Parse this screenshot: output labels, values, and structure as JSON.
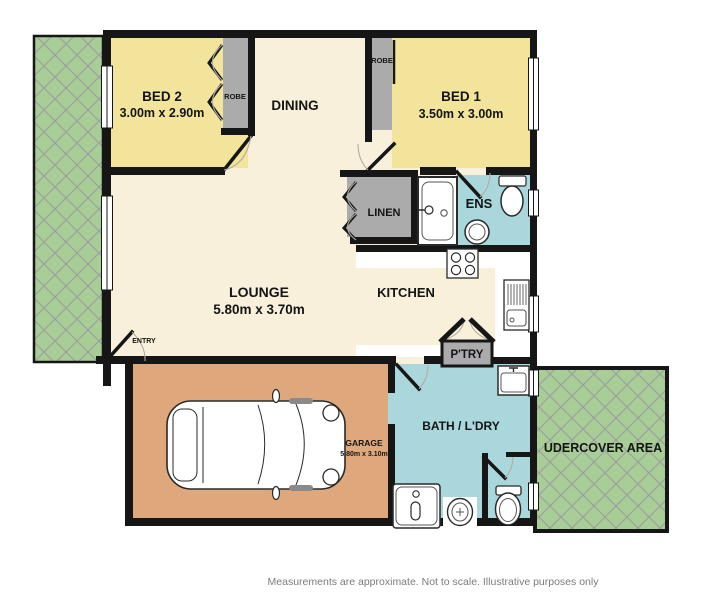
{
  "plan": {
    "rooms": {
      "bed2": {
        "name": "BED 2",
        "dims": "3.00m x 2.90m"
      },
      "bed1": {
        "name": "BED 1",
        "dims": "3.50m x 3.00m"
      },
      "dining": {
        "name": "DINING"
      },
      "lounge": {
        "name": "LOUNGE",
        "dims": "5.80m x 3.70m"
      },
      "kitchen": {
        "name": "KITCHEN"
      },
      "linen": {
        "name": "LINEN"
      },
      "ens": {
        "name": "ENS"
      },
      "pantry": {
        "name": "P'TRY"
      },
      "bath": {
        "name": "BATH / L'DRY"
      },
      "garage": {
        "name": "GARAGE",
        "dims": "5.80m x 3.10m"
      },
      "undercover": {
        "name": "UDERCOVER AREA"
      },
      "robe_bed2": {
        "name": "ROBE"
      },
      "robe_bed1": {
        "name": "ROBE"
      },
      "entry": {
        "name": "ENTRY"
      }
    },
    "colors": {
      "floor_cream": "#f9f0dc",
      "bedroom_yellow": "#f2e49b",
      "wet_area_blue": "#aad7dc",
      "garage_tan": "#dfa87c",
      "storage_grey": "#ababab",
      "garden_green": "#a9cd97",
      "wall_black": "#161616"
    },
    "footer": {
      "disclaimer": "Measurements are approximate.  Not to scale.  Illustrative purposes only"
    }
  }
}
